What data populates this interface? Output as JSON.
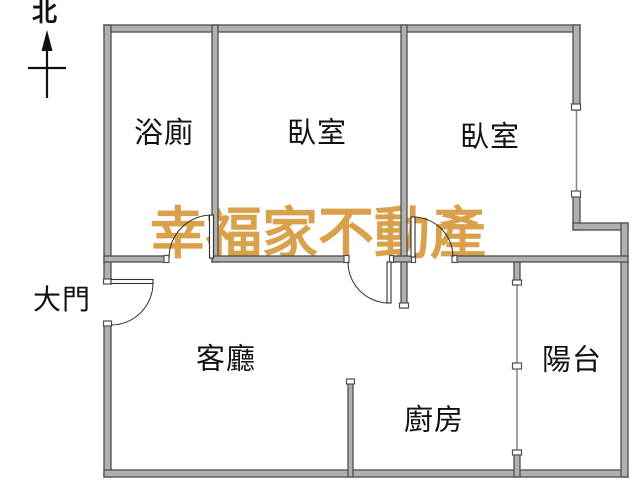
{
  "compass": {
    "label": "北"
  },
  "watermark": {
    "text": "幸福家不動產",
    "color": "#d9a14b"
  },
  "rooms": {
    "bathroom": {
      "label": "浴廁"
    },
    "bedroom1": {
      "label": "臥室"
    },
    "bedroom2": {
      "label": "臥室"
    },
    "entrance": {
      "label": "大門"
    },
    "living": {
      "label": "客廳"
    },
    "kitchen": {
      "label": "廚房"
    },
    "balcony": {
      "label": "陽台"
    }
  },
  "colors": {
    "background": "#ffffff",
    "wall_fill": "#b0b0b0",
    "wall_stroke": "#4f4f4f",
    "thin_line": "#8a8a8a",
    "door_line": "#2f2f2f",
    "text": "#111111",
    "watermark": "#d9a14b"
  }
}
